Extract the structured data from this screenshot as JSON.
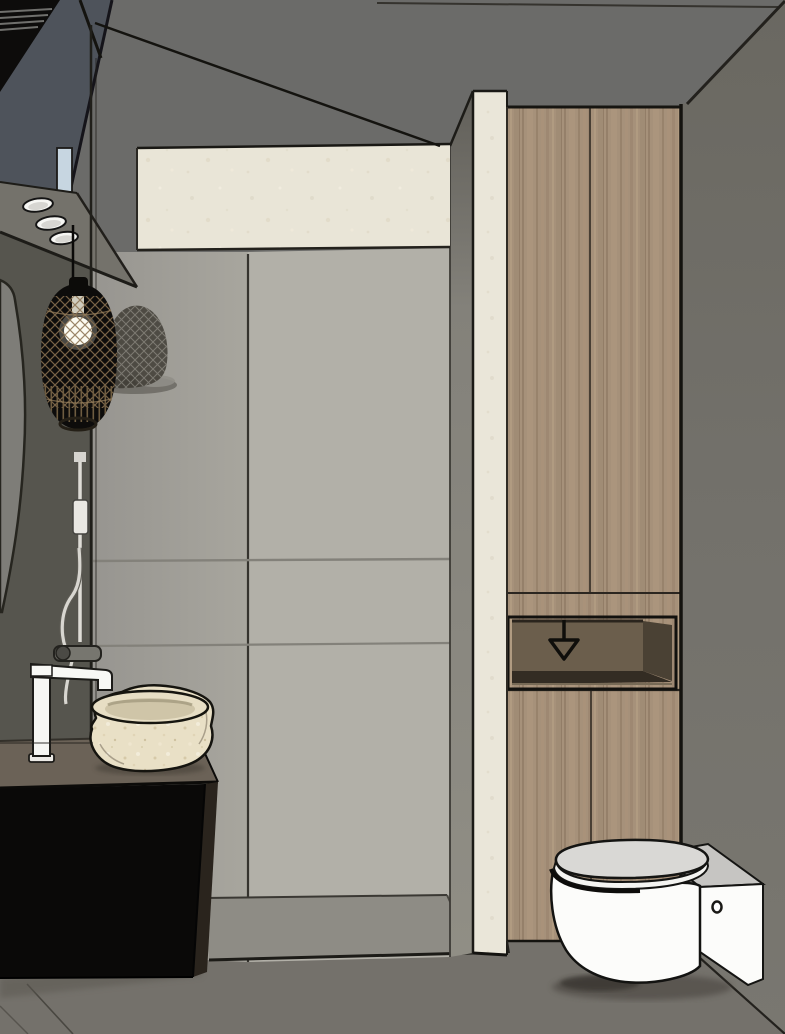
{
  "meta": {
    "kind": "3d-interior-render",
    "room": "bathroom",
    "render_style": "sketchup-like flat shading with black edge lines",
    "visible_text": "none"
  },
  "icons": {
    "down-arrow-marker": "outlined downward arrow drawn inside the open niche of the wooden cabinet"
  },
  "objects": [
    {
      "name": "ceiling",
      "desc": "dark gray ceiling plane"
    },
    {
      "name": "right-wall",
      "desc": "dark warm gray wall on the right"
    },
    {
      "name": "left-wall",
      "desc": "dark gray wall on the left with round mirror edge"
    },
    {
      "name": "upper-shelf-unit",
      "desc": "dark floating unit top-left with three recessed spotlights and blue glass"
    },
    {
      "name": "pendant-light",
      "desc": "black rattan cage pendant with visible bulb, casts lattice shadow"
    },
    {
      "name": "shower",
      "desc": "walk-in shower with glass screen, large gray tiles, recessed tray"
    },
    {
      "name": "cream-pilaster",
      "desc": "travertine colored partition column and header band"
    },
    {
      "name": "wooden-cabinet",
      "desc": "tall oak cabinet with open niche and down-arrow marker"
    },
    {
      "name": "toilet",
      "desc": "white wall-hung toilet with side box"
    },
    {
      "name": "vanity",
      "desc": "black vanity cabinet, taupe counter, rough stone vessel sink, white tall faucet"
    },
    {
      "name": "shower-fixtures",
      "desc": "white riser rail, hose and gray mixer"
    }
  ],
  "palette": {
    "ceiling": "#6b6b69",
    "rightWall": "#73716b",
    "rightWallTop": "#6a6861",
    "floor": "#74716b",
    "bluePlane": "#4e535b",
    "glassBlue": "#c7d6e1",
    "blackUnit": "#0d0c0b",
    "soffit": "#74726b",
    "leftWallLower": "#56554e",
    "mirror": "#7e7d78",
    "sideWall": "#9e9c94",
    "backWall": "#b2b0a8",
    "showerFloor": "#8e8c85",
    "innerStrip": "#8b897f",
    "innerStripTop": "#615f59",
    "cream": "#e9e5d7",
    "woodBase": "#a6917a",
    "nicheBack": "#6b5e4c",
    "nicheSide": "#4a4134",
    "nicheBottom": "#332c23",
    "toiletWhite": "#fcfcfa",
    "toiletLidTop": "#d9d8d5",
    "toiletBoxTop": "#c6c5c2",
    "counterTop": "#6b6257",
    "cabinetFront": "#0a0908",
    "cabinetSide": "#2a241d",
    "stoneRim": "#e7dec4",
    "stoneInner": "#cfc5a8",
    "fixtureGray": "#77766f",
    "railWhite": "#dedcd6",
    "edgeLine": "#1b1a16",
    "arrow": "#0f0e0b",
    "seamLine": "#83817a",
    "shadow": "#27221b"
  }
}
